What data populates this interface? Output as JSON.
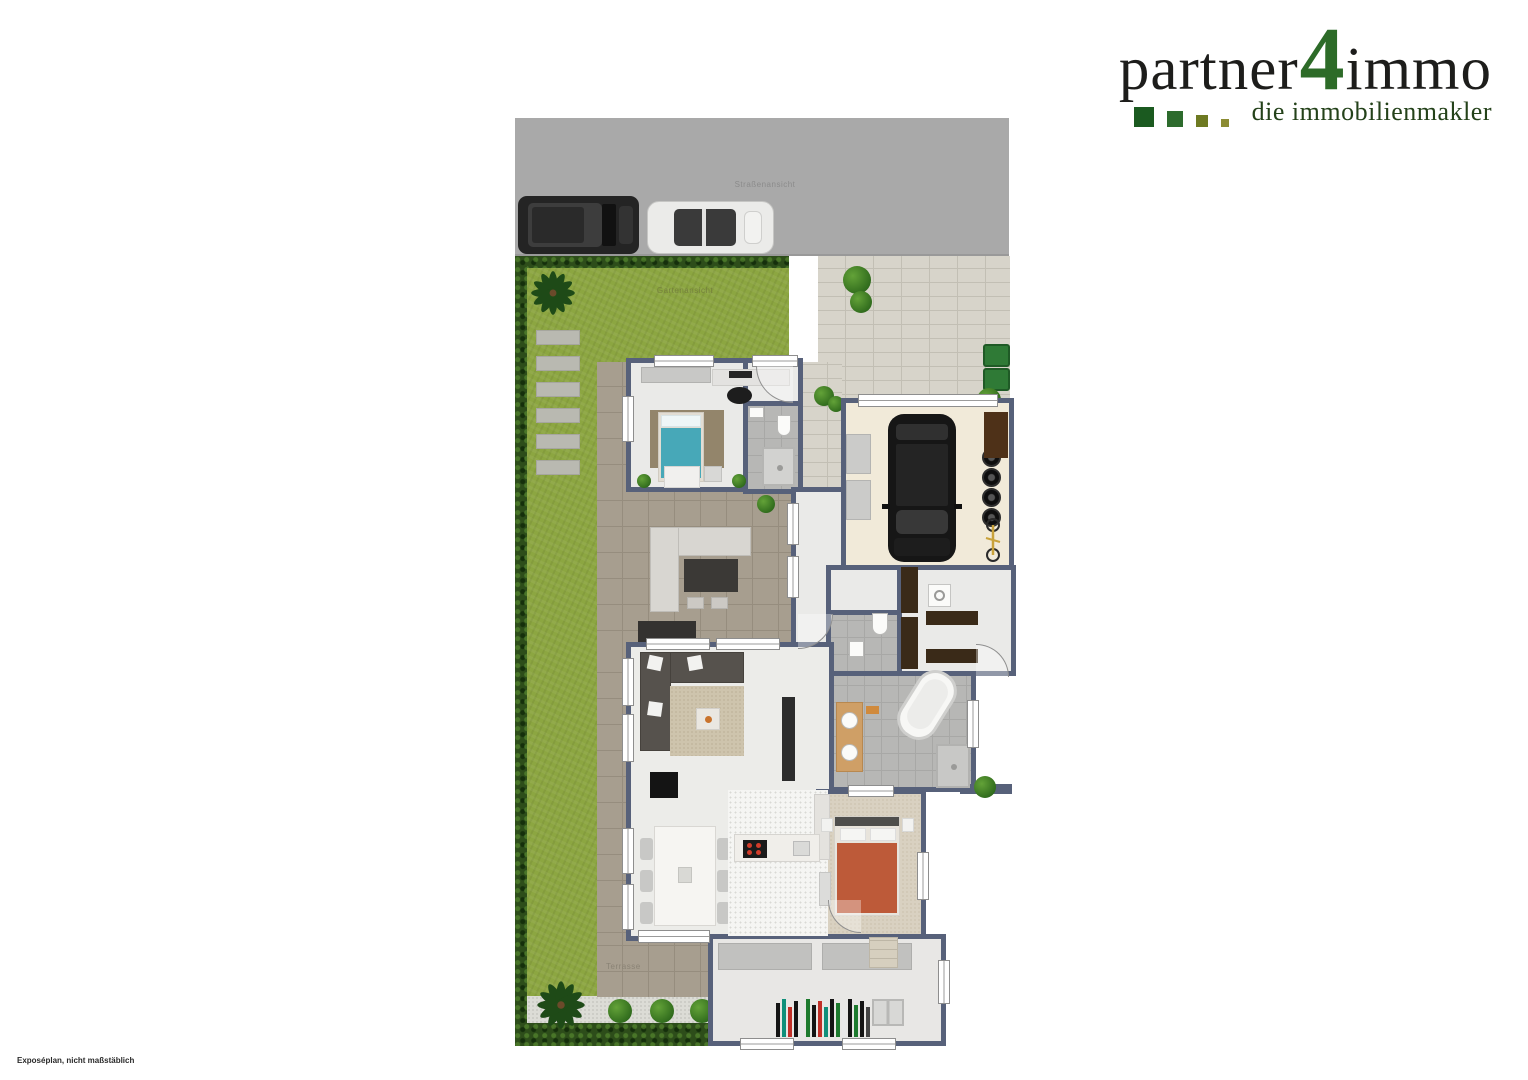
{
  "logo": {
    "brand_part1": "partner",
    "brand_number": "4",
    "brand_part2": "immo",
    "tagline": "die immobilienmakler",
    "colors": {
      "text": "#1d1d1b",
      "number_green": "#2d6b28",
      "tagline_green": "#24421a",
      "squares": [
        "#1b5a20",
        "#2d6b2d",
        "#6e7a22",
        "#8c8c33"
      ]
    }
  },
  "plan": {
    "street_label": "Straßenansicht",
    "garden_label": "Gartenansicht",
    "terrace_label": "Terrasse",
    "colors": {
      "street": "#a9a9a9",
      "grass": "#8ca641",
      "hedge": "#2d4d1a",
      "wall": "#57617a",
      "terrace_tile": "#a79e8f",
      "paving": "#d7d4ca",
      "bath_tile": "#b7b7b5",
      "garage_floor": "#f1ead9",
      "bed_teal": "#47a8b8",
      "bed_red": "#bd5a39",
      "bins_green": "#2f7a36"
    }
  },
  "disclaimer": "Exposéplan, nicht maßstäblich"
}
